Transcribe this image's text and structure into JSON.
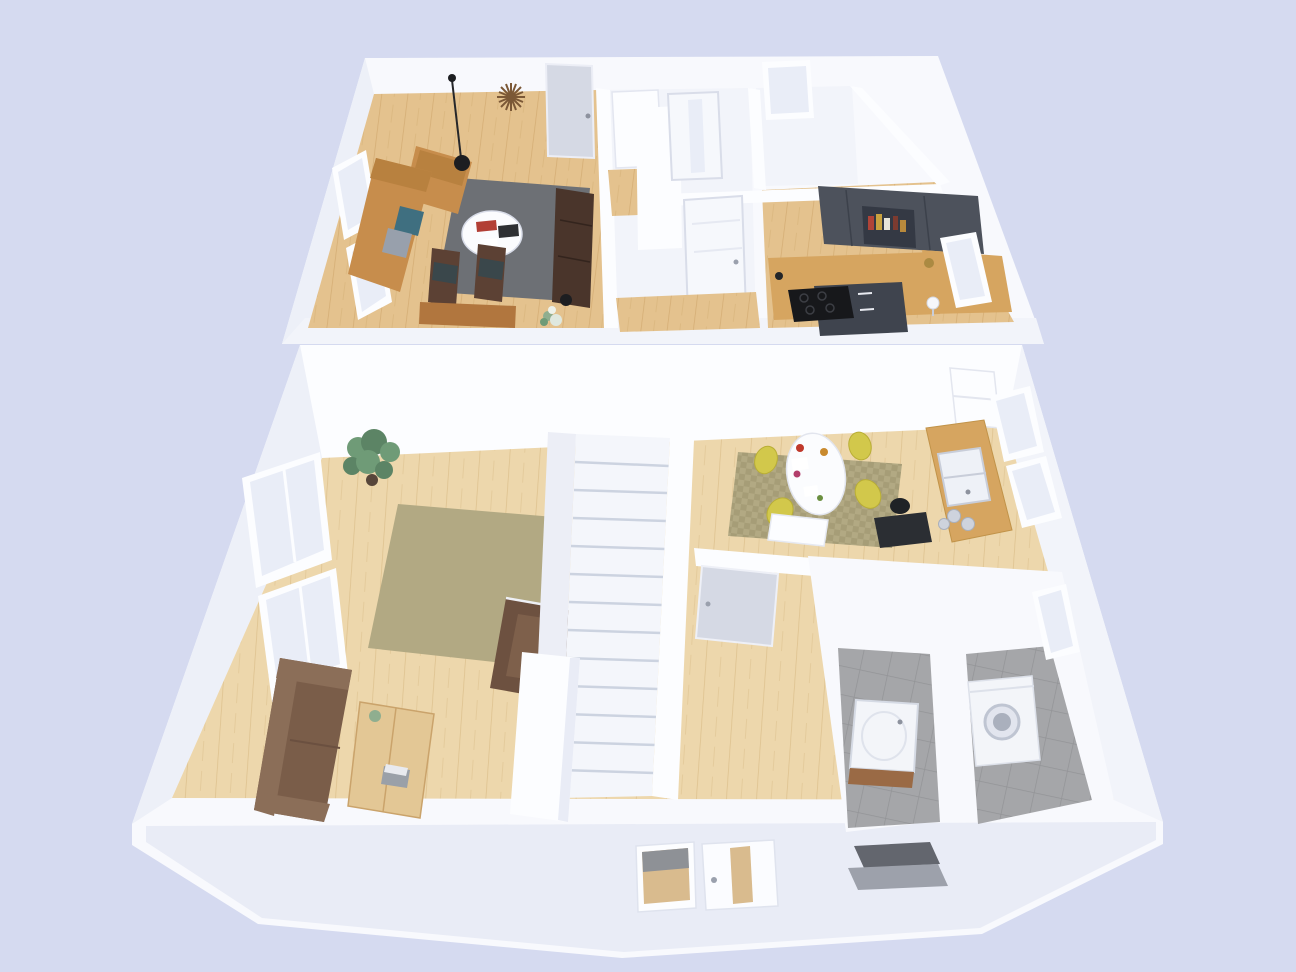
{
  "scene": {
    "type": "isometric-3d-floor-plan",
    "floors": [
      {
        "name": "upper-floor",
        "rooms": [
          "living-room",
          "stair-hallway",
          "bathroom",
          "kitchen"
        ],
        "furniture": [
          "corner-sofa-tan",
          "coffee-table-round",
          "rug-gray",
          "pendant-lamp",
          "sunburst-wall-clock",
          "media-shelf",
          "dining-chairs",
          "dining-table",
          "wardrobe-closet",
          "kitchen-upper-cabinets",
          "kitchen-counter",
          "cooktop",
          "kitchen-base-cabinets",
          "table-lamp"
        ]
      },
      {
        "name": "ground-floor",
        "rooms": [
          "living-room",
          "dining-area",
          "kitchen",
          "entrance-hall",
          "wc",
          "utility-room"
        ],
        "furniture": [
          "sofa-brown",
          "armchair-brown",
          "plank-coffee-table",
          "rug-olive",
          "monstera-plant",
          "staircase",
          "dining-table-oval",
          "yellow-chairs",
          "desk-black",
          "kitchen-sink-counter",
          "fridge-cabinet",
          "vanity-sink",
          "washing-machine",
          "entrance-canopy",
          "front-door"
        ]
      }
    ]
  },
  "colors": {
    "background": "#d5daf0",
    "plate": "#f8f9fd",
    "plate_face": "#edf0f8",
    "wall": "#fcfdff",
    "wall_shade": "#f2f4fa",
    "glass": "#e9edf7",
    "wood_floor_upper": "#e4c28e",
    "wood_floor_lower": "#edd7ac",
    "rug_gray": "#6d7075",
    "rug_olive": "#b2a983",
    "sofa_tan": "#c78d4c",
    "sofa_brown": "#7a5d49",
    "armchair_brown": "#6d5140",
    "wood_counter": "#d6a560",
    "cabinet_dark": "#4d525c",
    "cabinet_base": "#3f444e",
    "chair_yellow": "#d2c84b",
    "tile": "#a5a6a9",
    "plant": "#6f9b77",
    "appliance": "#f3f5f9",
    "canopy": "#63666e",
    "step": "#9da1ab",
    "door": "#d5d9e4",
    "black": "#1d1e21",
    "pillow_teal": "#3f6f80",
    "pillow_gray": "#98a0ac",
    "clock_brown": "#7b5836"
  }
}
